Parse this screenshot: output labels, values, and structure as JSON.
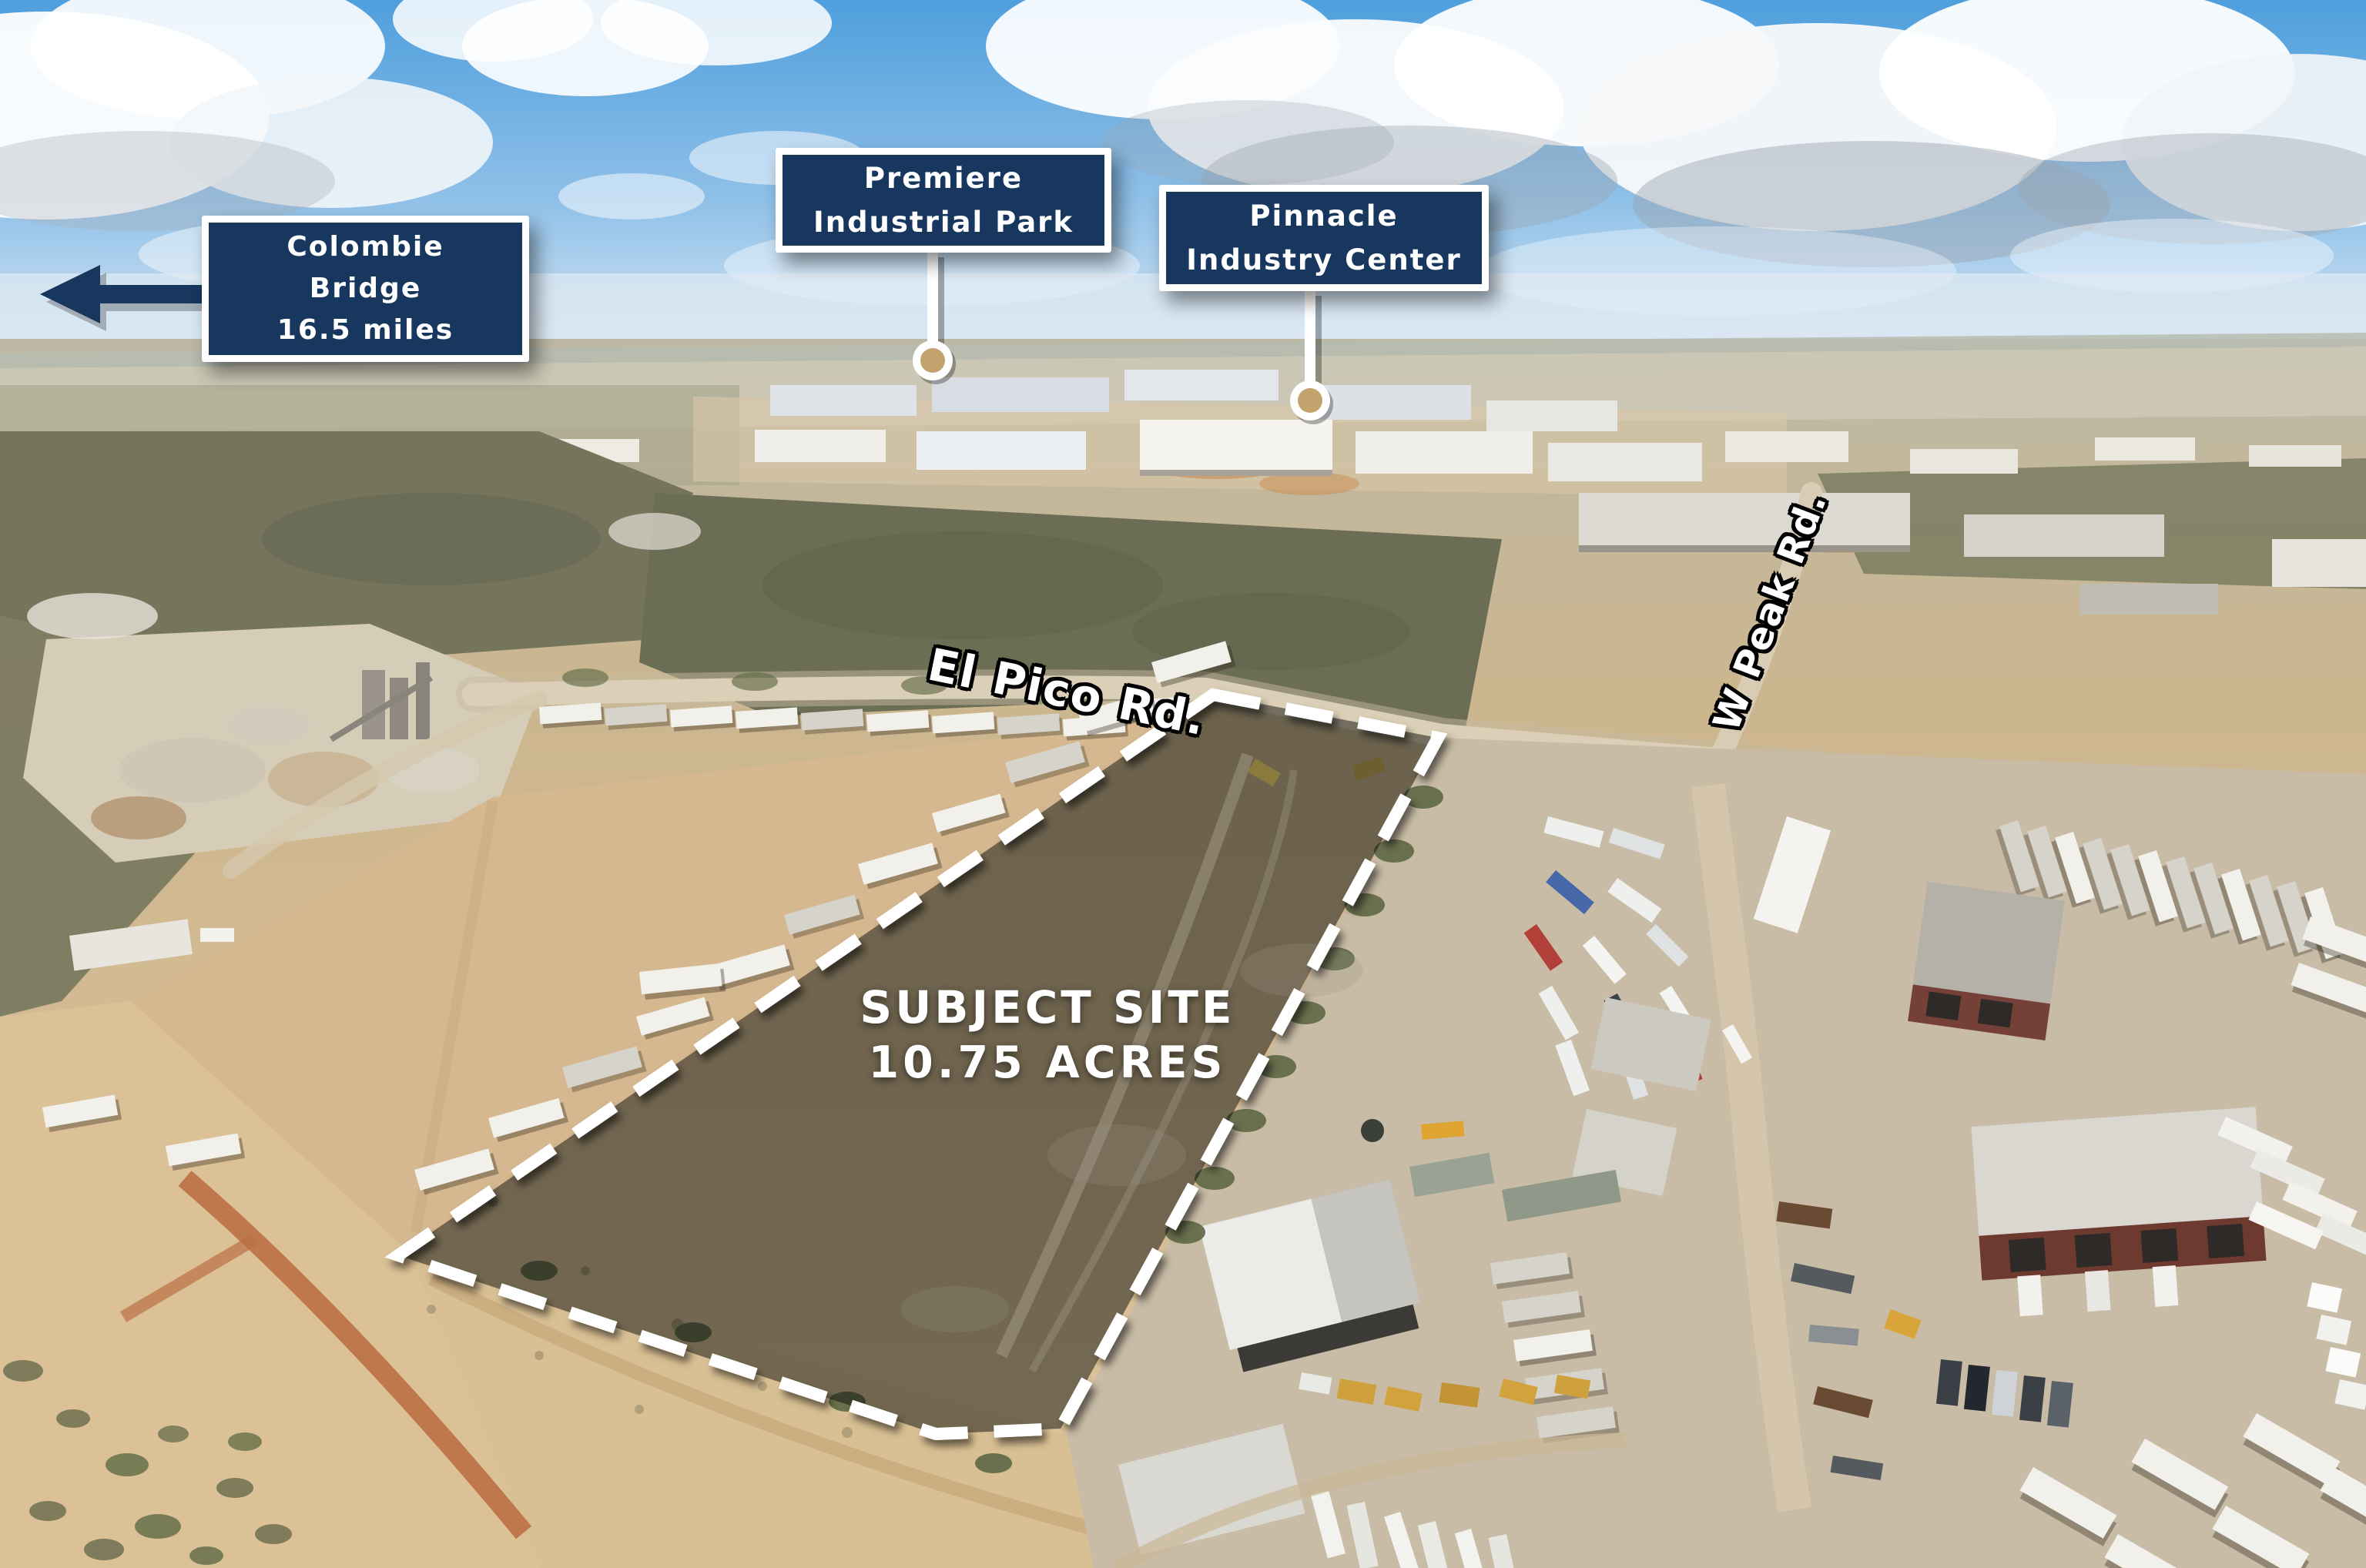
{
  "callouts": {
    "colombie_bridge": {
      "lines": [
        "Colombie",
        "Bridge",
        "16.5 miles"
      ]
    },
    "premiere_industrial_park": {
      "lines": [
        "Premiere",
        "Industrial Park"
      ]
    },
    "pinnacle_industry_center": {
      "lines": [
        "Pinnacle",
        "Industry Center"
      ]
    }
  },
  "road_labels": {
    "el_pico": "El Pico Rd.",
    "w_peak": "W Peak Rd."
  },
  "site": {
    "name": "SUBJECT SITE",
    "area": "10.75 ACRES"
  },
  "colors": {
    "callout_background": "#17375e",
    "callout_border": "#ffffff",
    "callout_text": "#ffffff",
    "arrow": "#17375e",
    "marker_ring": "#ffffff",
    "marker_fill": "#c2a36e",
    "boundary_dash": "#ffffff",
    "road_label_text": "#ffffff",
    "road_label_outline": "#000000"
  }
}
